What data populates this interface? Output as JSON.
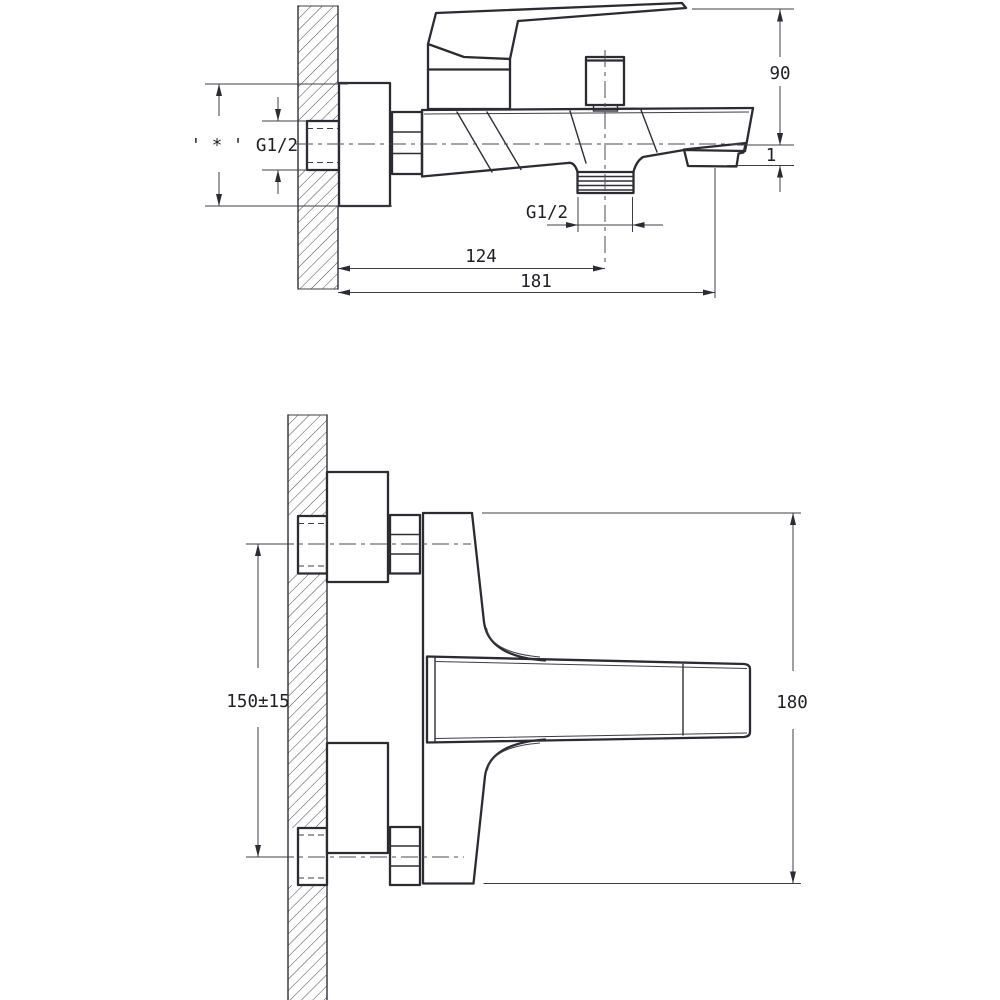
{
  "drawing": {
    "kind": "technical dimension drawing, two orthographic views of a wall-mounted single-lever bath mixer",
    "background": "#ffffff"
  },
  "side_view": {
    "dimensions": {
      "note_star": "' * '",
      "inlet_thread": "G1/2",
      "handle_height": "90",
      "spout_step": "1",
      "outlet_thread": "G1/2",
      "wall_to_outlet": "124",
      "wall_to_spout_end": "181"
    }
  },
  "front_view": {
    "dimensions": {
      "hole_spacing": "150±15",
      "overall_height": "180"
    }
  },
  "colors": {
    "line_bold": "#2b2b33",
    "line_thin": "#3d3d47",
    "text": "#1f1f26",
    "background": "#ffffff"
  }
}
